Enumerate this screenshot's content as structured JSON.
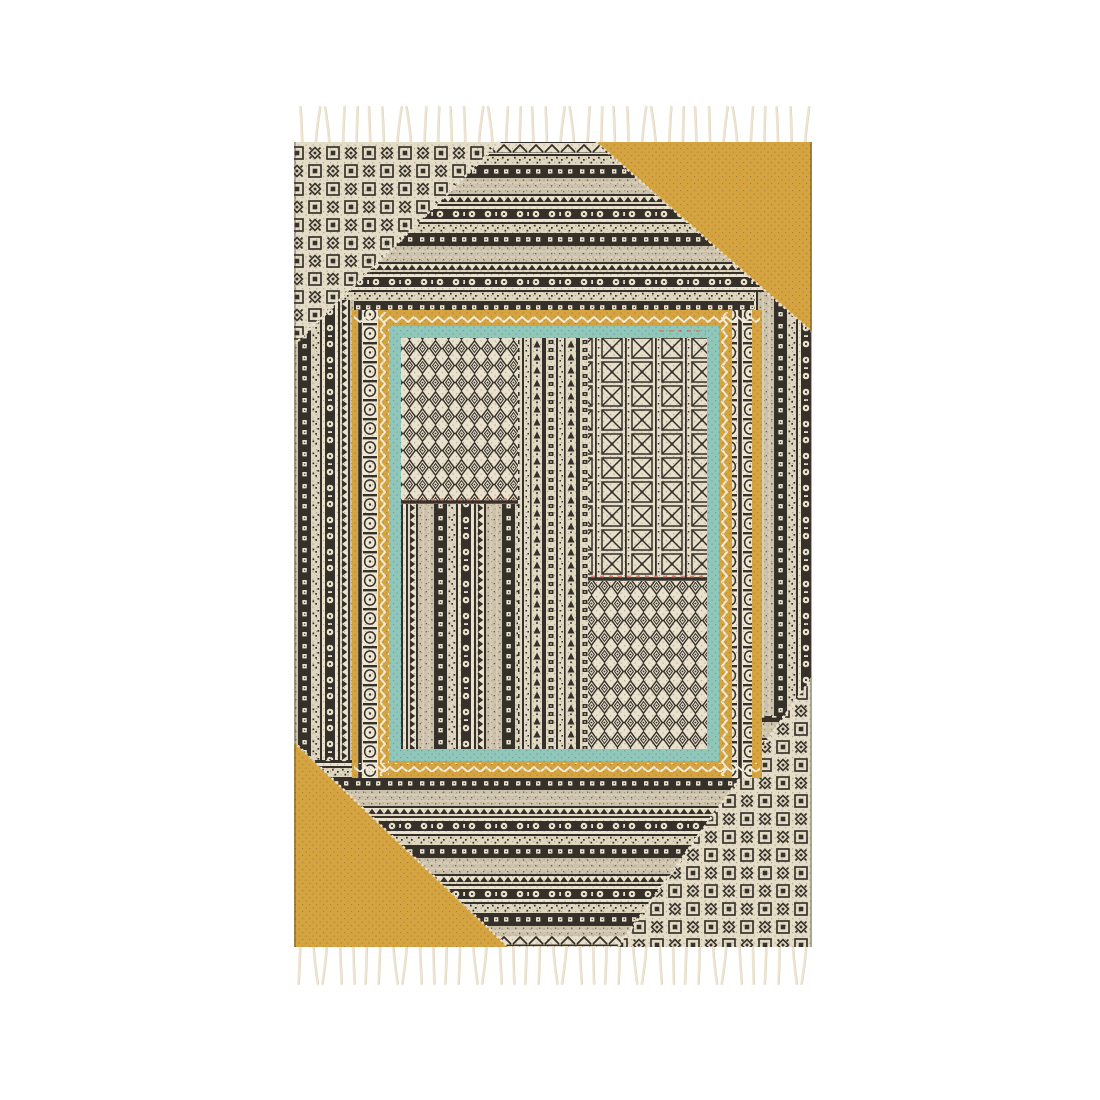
{
  "scene": {
    "background_color": "#ffffff",
    "description": "Product photo of a flat-woven block-print kilim rug with knotted fringe at top and bottom, shown full length on a plain white background"
  },
  "rug": {
    "base_color": "#e9e1cc",
    "ink_color": "#35302a",
    "accent_colors": {
      "mustard": "#d5a440",
      "teal": "#8fc7bb",
      "coral_stitch": "#d9806e",
      "fringe": "#ece4d1",
      "fringe_shadow": "#cdc1a5"
    },
    "regions": {
      "top_left_corner": "black and cream medallion tile block-print",
      "top_right_corner": "solid mustard triangle",
      "bottom_left_corner": "solid mustard triangle",
      "bottom_right_corner": "black and cream medallion tile block-print",
      "field": "horizontal striped band block-print",
      "side_borders": "vertical striped band block-print",
      "inner_border": "mustard band with cream zigzags and bead-chain columns around a teal band",
      "inner_panel": "patchwork of diamond lattice and striped block-print panels with coral stitch accents"
    },
    "fringe": {
      "top": {
        "count": 38
      },
      "bottom": {
        "count": 39
      }
    }
  }
}
